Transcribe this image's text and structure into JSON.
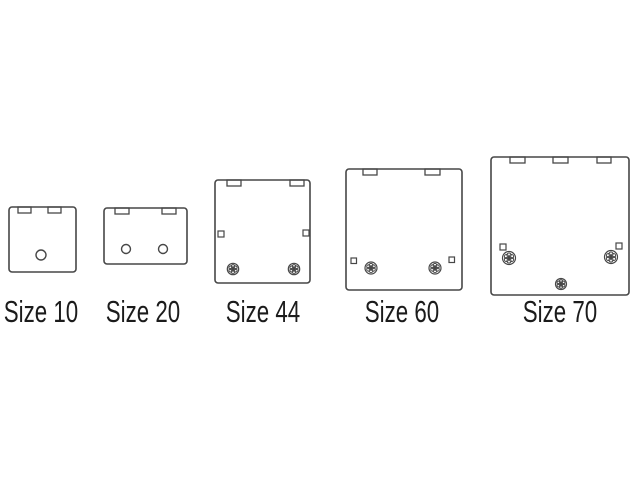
{
  "page": {
    "background": "#ffffff",
    "line_color": "#474747",
    "text_color": "#1b1b1b"
  },
  "figure": {
    "tab_height": 6,
    "boxes": [
      {
        "label": "Size 10",
        "label_x": 41,
        "rect": {
          "x": 9,
          "y": 207,
          "w": 67,
          "h": 65
        },
        "tabs": [
          {
            "x": 18,
            "w": 13
          },
          {
            "x": 48,
            "w": 13
          }
        ],
        "holes": [
          {
            "cx": 41,
            "cy": 255,
            "r": 5
          }
        ],
        "squares": [],
        "screws": []
      },
      {
        "label": "Size 20",
        "label_x": 143,
        "rect": {
          "x": 104,
          "y": 208,
          "w": 83,
          "h": 56
        },
        "tabs": [
          {
            "x": 115,
            "w": 14
          },
          {
            "x": 162,
            "w": 14
          }
        ],
        "holes": [
          {
            "cx": 126,
            "cy": 249,
            "r": 4.5
          },
          {
            "cx": 163,
            "cy": 249,
            "r": 4.5
          }
        ],
        "squares": [],
        "screws": []
      },
      {
        "label": "Size 44",
        "label_x": 263,
        "rect": {
          "x": 215,
          "y": 180,
          "w": 95,
          "h": 103
        },
        "tabs": [
          {
            "x": 227,
            "w": 14
          },
          {
            "x": 290,
            "w": 14
          }
        ],
        "holes": [],
        "squares": [
          {
            "x": 218,
            "y": 231,
            "s": 6
          },
          {
            "x": 303,
            "y": 230,
            "s": 6
          }
        ],
        "screws": [
          {
            "cx": 233,
            "cy": 269,
            "r": 5.7
          },
          {
            "cx": 294,
            "cy": 269,
            "r": 5.7
          }
        ]
      },
      {
        "label": "Size 60",
        "label_x": 402,
        "rect": {
          "x": 346,
          "y": 169,
          "w": 116,
          "h": 121
        },
        "tabs": [
          {
            "x": 363,
            "w": 14
          },
          {
            "x": 425,
            "w": 15
          }
        ],
        "holes": [],
        "squares": [
          {
            "x": 351,
            "y": 258,
            "s": 5.5
          },
          {
            "x": 449,
            "y": 257,
            "s": 5.5
          }
        ],
        "screws": [
          {
            "cx": 371,
            "cy": 268,
            "r": 6
          },
          {
            "cx": 435,
            "cy": 268,
            "r": 6
          }
        ]
      },
      {
        "label": "Size 70",
        "label_x": 560,
        "rect": {
          "x": 491,
          "y": 157,
          "w": 138,
          "h": 138
        },
        "tabs": [
          {
            "x": 510,
            "w": 15
          },
          {
            "x": 553,
            "w": 15
          },
          {
            "x": 597,
            "w": 14
          }
        ],
        "holes": [],
        "squares": [
          {
            "x": 500,
            "y": 244,
            "s": 6
          },
          {
            "x": 616,
            "y": 243,
            "s": 6
          }
        ],
        "screws": [
          {
            "cx": 509,
            "cy": 258,
            "r": 6.5
          },
          {
            "cx": 611,
            "cy": 257,
            "r": 6.5
          },
          {
            "cx": 561,
            "cy": 284,
            "r": 5.5
          }
        ]
      }
    ]
  }
}
